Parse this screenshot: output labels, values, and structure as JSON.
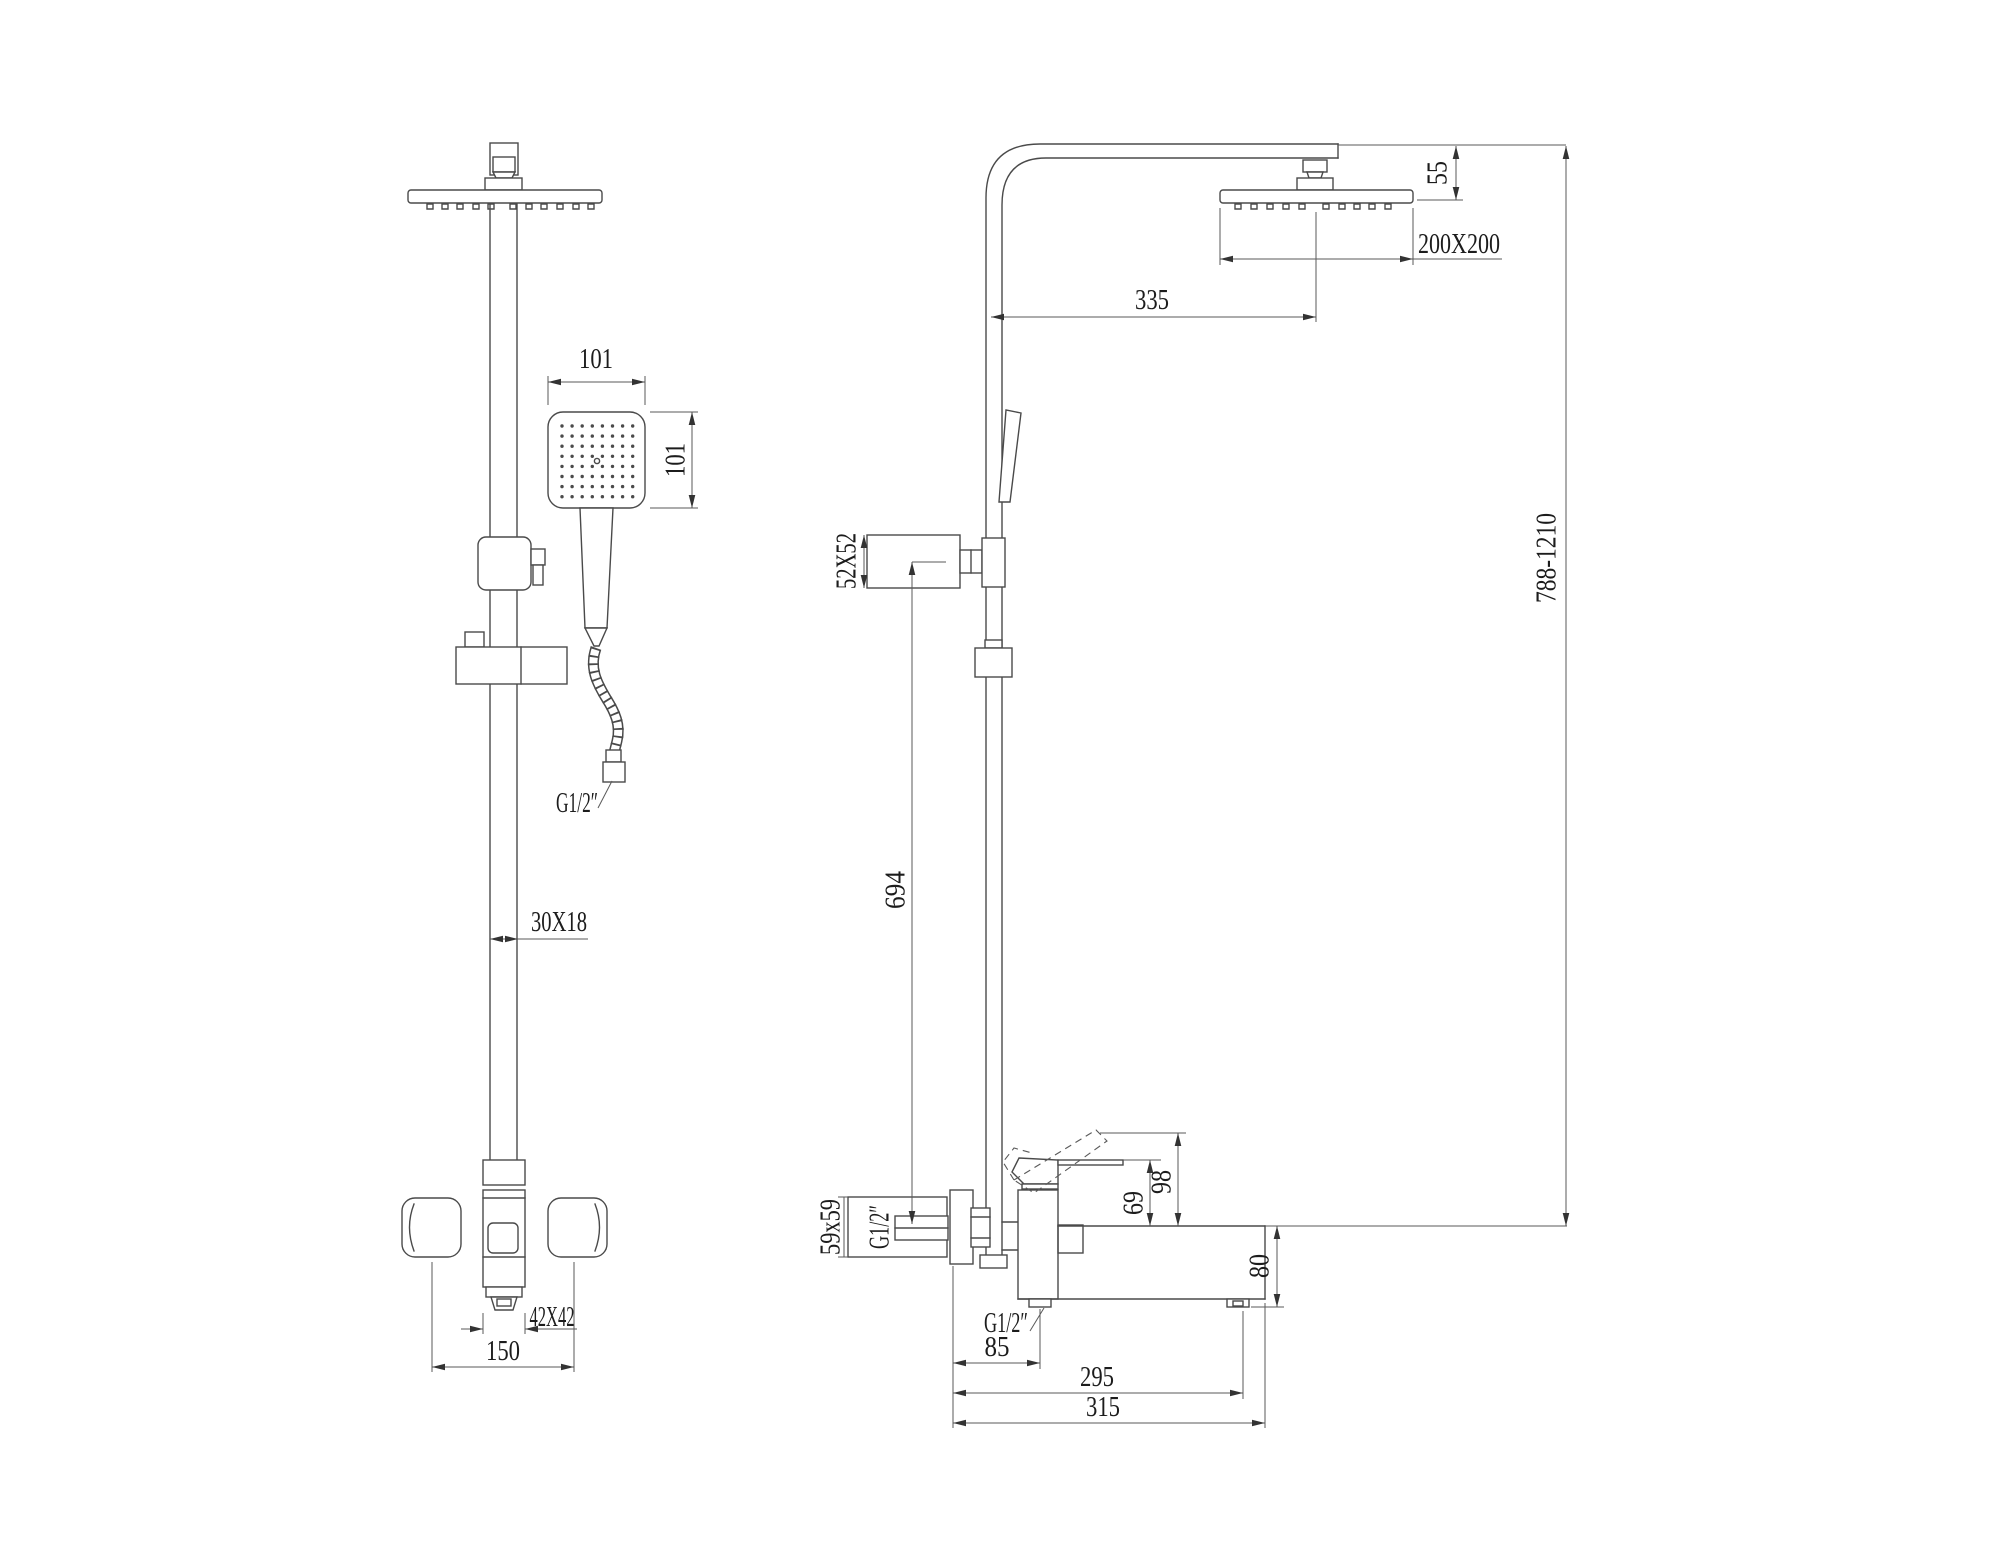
{
  "canvas": {
    "background": "#ffffff",
    "line_color": "#4a4a4a",
    "dim_color": "#5a5a5a",
    "text_color": "#1c1c1c"
  },
  "front": {
    "hand_shower_width": "101",
    "hand_shower_height": "101",
    "hose_thread": "G1/2″",
    "pipe_profile": "30X18",
    "valve_profile": "42X42",
    "valve_width": "150"
  },
  "side": {
    "head_drop": "55",
    "head_size": "200X200",
    "arm_reach": "335",
    "holder_profile": "52X52",
    "holder_height": "694",
    "column_height_range": "788-1210",
    "wall_union_profile": "59x59",
    "wall_union_thread": "G1/2″",
    "lever_height": "69",
    "lever_height_raised": "98",
    "spout_height": "80",
    "outlet_thread": "G1/2″",
    "outlet_offset": "85",
    "spout_reach": "295",
    "spout_reach_total": "315"
  }
}
